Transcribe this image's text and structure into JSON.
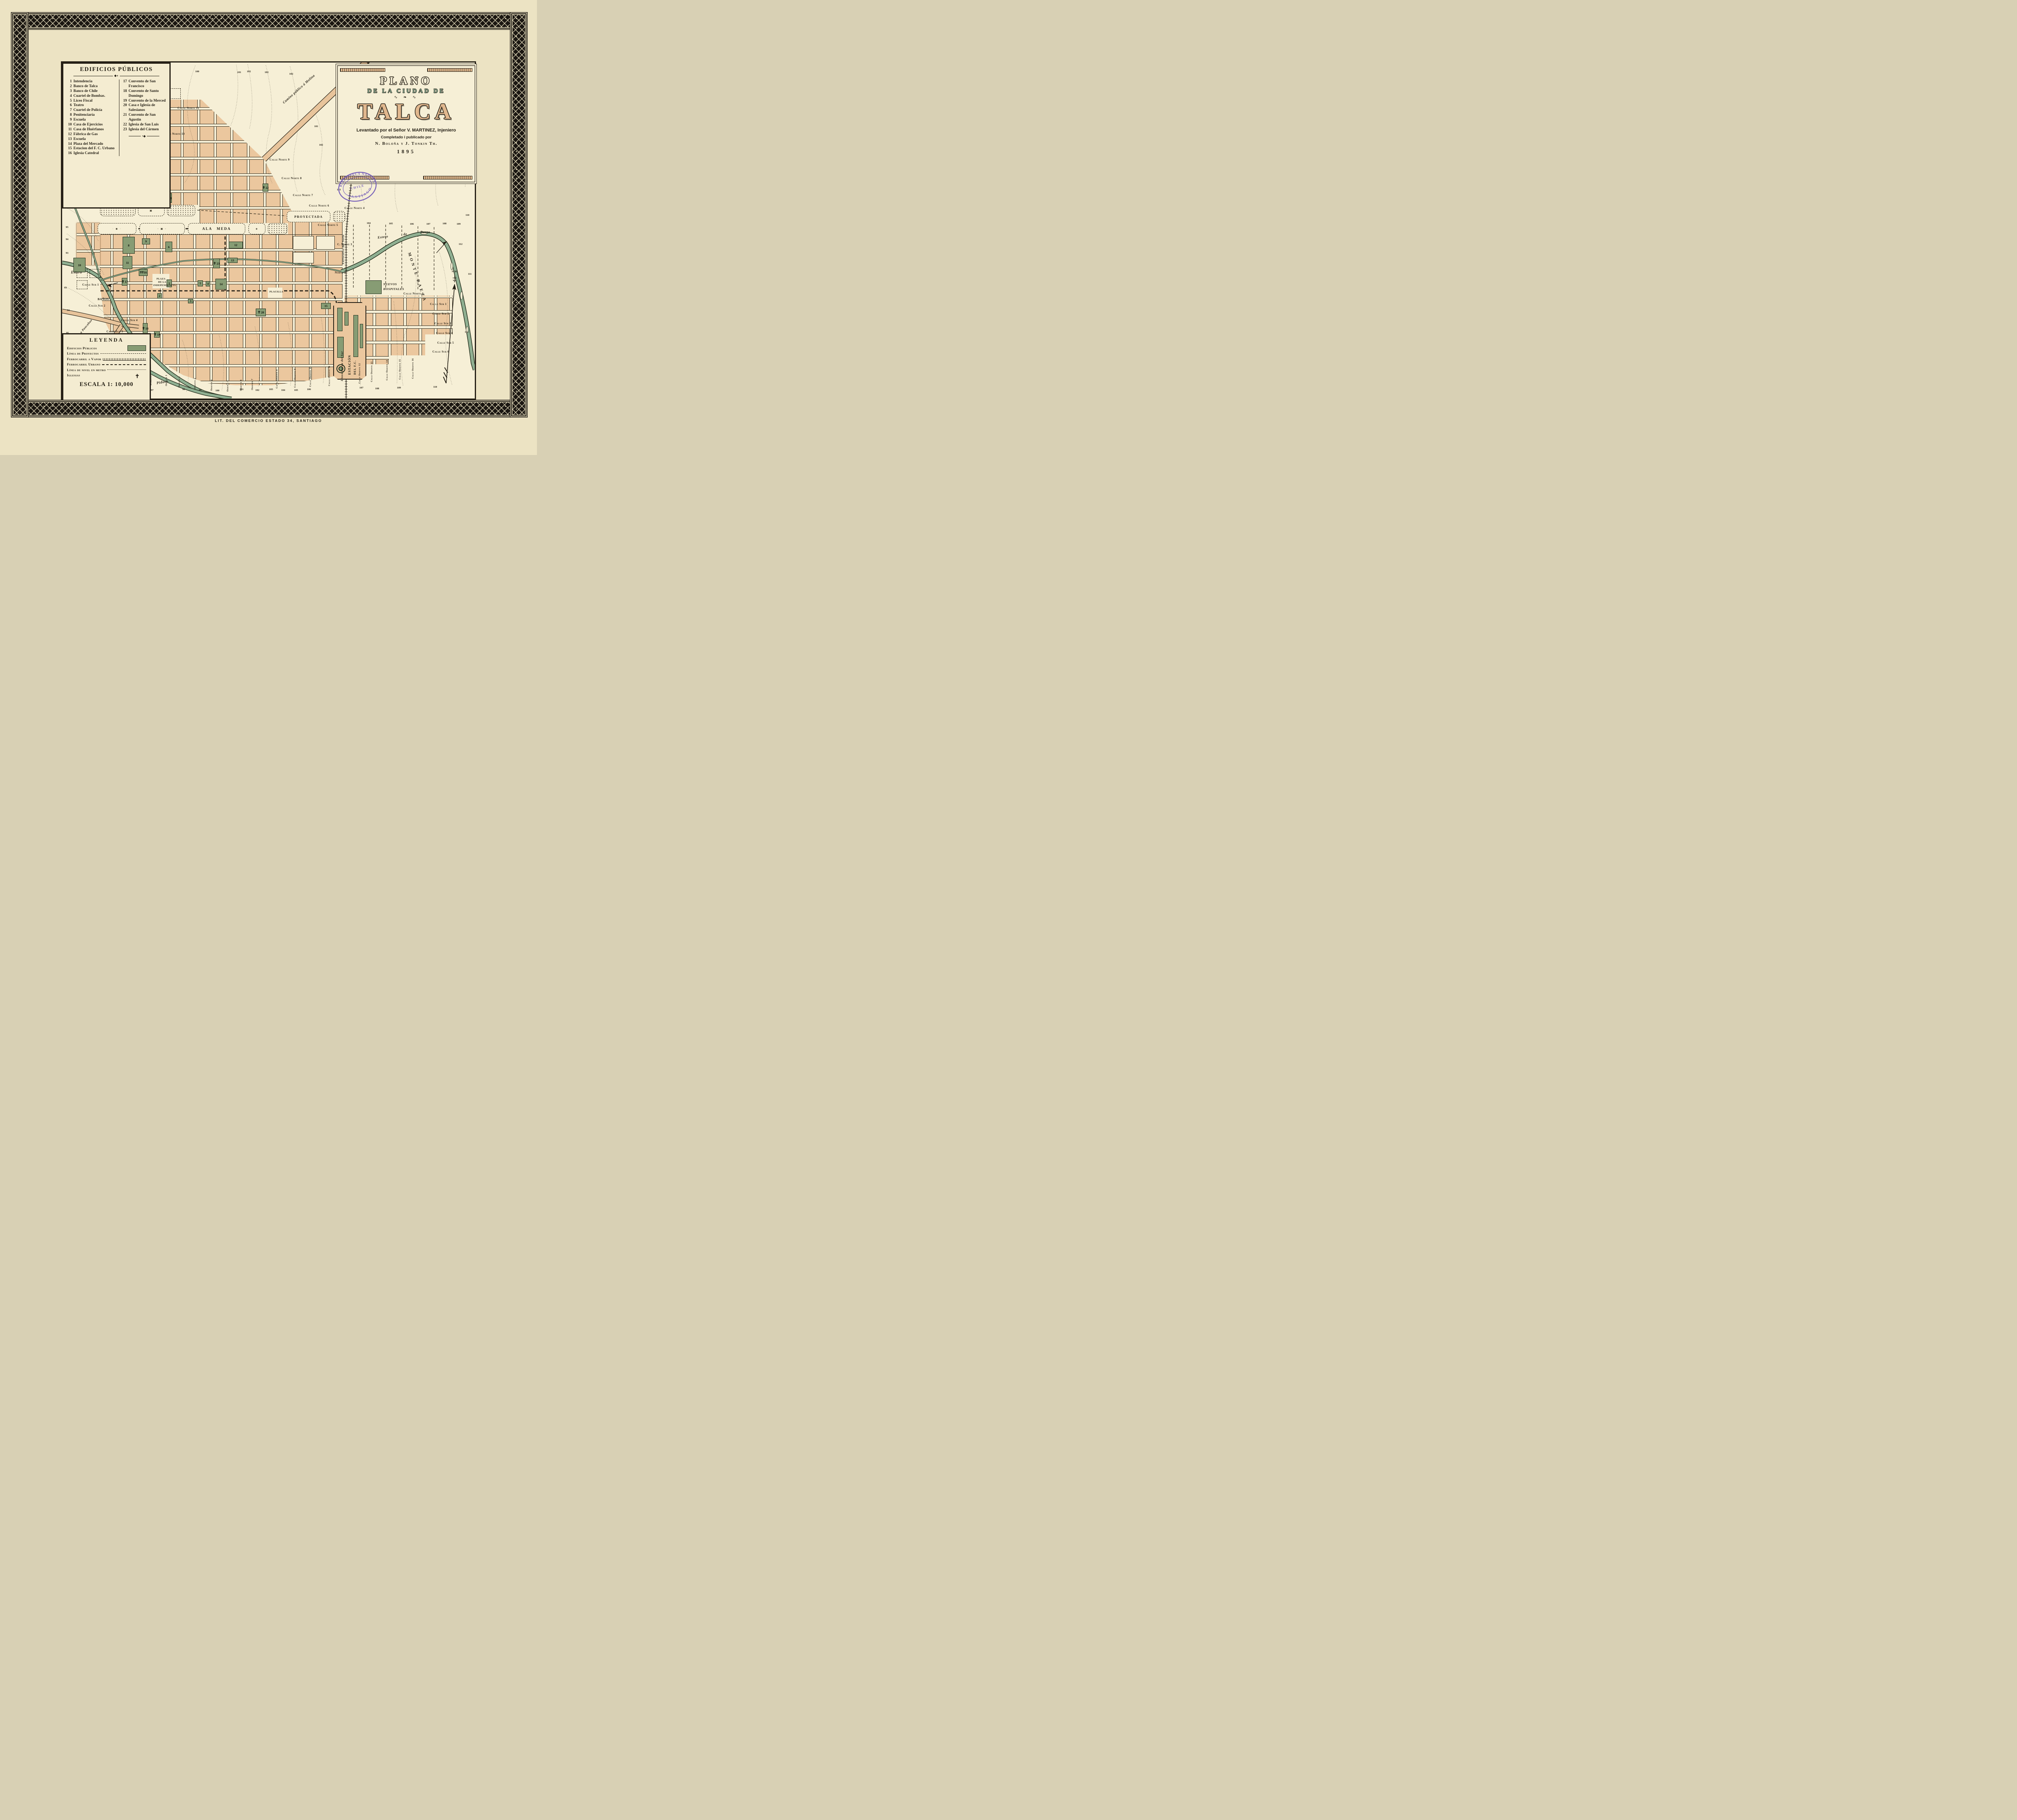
{
  "page": {
    "caption": "LIT. DEL COMERCIO ESTADO 34, SANTIAGO"
  },
  "colors": {
    "page_background": "#ece3c3",
    "map_paper": "#f6efd6",
    "ink": "#241f15",
    "city_block": "#ebc79e",
    "public_building_green": "#879c74",
    "river_green": "#90b092",
    "title_tan": "#e0b78e",
    "title_green": "#7fa088",
    "stamp_purple": "#6f58b8"
  },
  "edificios": {
    "title": "EDIFICIOS PÚBLICOS",
    "items": [
      {
        "n": "1",
        "label": "Intendencia"
      },
      {
        "n": "2",
        "label": "Banco de Talca"
      },
      {
        "n": "3",
        "label": "Banco de Chile"
      },
      {
        "n": "4",
        "label": "Cuartel de Bombas."
      },
      {
        "n": "5",
        "label": "Liceo Fiscal"
      },
      {
        "n": "6",
        "label": "Teatro"
      },
      {
        "n": "7",
        "label": "Cuartel de Policía"
      },
      {
        "n": "8",
        "label": "Penitenciaría"
      },
      {
        "n": "9",
        "label": "Escuela"
      },
      {
        "n": "10",
        "label": "Casa de Ejercicios"
      },
      {
        "n": "11",
        "label": "Casa de Huérfanos"
      },
      {
        "n": "12",
        "label": "Fábrica de Gas"
      },
      {
        "n": "13",
        "label": "Escuela"
      },
      {
        "n": "14",
        "label": "Plaza del Mercado"
      },
      {
        "n": "15",
        "label": "Estacion del F. C. Urbano"
      },
      {
        "n": "16",
        "label": "Iglesia Catedral"
      },
      {
        "n": "17",
        "label": "Convento de San Francisco"
      },
      {
        "n": "18",
        "label": "Convento de Santo Domingo"
      },
      {
        "n": "19",
        "label": "Convento de la Merced"
      },
      {
        "n": "20",
        "label": "Casa e Iglesia de Salesianos"
      },
      {
        "n": "21",
        "label": "Convento de San Agustin"
      },
      {
        "n": "22",
        "label": "Iglesia de San Luis"
      },
      {
        "n": "23",
        "label": "Iglesia del Cármen"
      }
    ]
  },
  "cartouche": {
    "plano": "PLANO",
    "de_la_ciudad": "DE LA CIUDAD DE",
    "talca": "TALCA",
    "credit1": "Levantado por el Señor V. MARTINEZ, Injeniero",
    "credit2": "Completado i publicado por",
    "credit3": "N. Boloña y J. Tonkin Th.",
    "year": "1895"
  },
  "stamp": {
    "top": "BIBLIOTECA NACIONAL",
    "middle": "CHILE",
    "bottom": "SANTIAGO"
  },
  "leyenda": {
    "title": "LEYENDA",
    "items": [
      {
        "label": "Edificios Públicos"
      },
      {
        "label": "Línea de Proyectos"
      },
      {
        "label": "Ferrocarril a Vapor"
      },
      {
        "label": "Ferrocarril Urbano"
      },
      {
        "label": "Línea de nivel en metro"
      },
      {
        "label": "Iglesias"
      }
    ],
    "scale": "ESCALA 1: 10,000"
  },
  "map": {
    "labels": {
      "norte11": "Calle Norte 11",
      "norte10": "Calle Norte 10",
      "norte9": "Calle Norte 9",
      "norte8": "Calle Norte 8",
      "norte7": "Calle Norte 7",
      "norte6": "Calle Norte 6",
      "norte5": "Calle Norte 5",
      "norte4": "Calle Norte 4",
      "norte4w": "Calle Norte 4",
      "norte3": "C. Norte 3",
      "norte2": "Norte 2",
      "norte1": "Calle Norte 1",
      "alameda": "ALA MEDA",
      "proyectada": "PROYECTADA",
      "molina": "Camino público á Molina",
      "pencahue": "Camino a Pancahue",
      "estero": "Estero",
      "estero_b1": "Estero",
      "estero_b2": "de",
      "estero_b3": "Baeza",
      "piduco": "Piduco",
      "banos": "BAÑOS",
      "placilla": "PLACILLA",
      "plaza1": "PLAZA",
      "plaza2": "DE LA",
      "plaza3": "INDEPENDENCIA",
      "hosp1": "NUEVOS",
      "hosp2": "HOSPITALES",
      "est1": "ESTACIÓN",
      "est2": "DEL F.C.",
      "est3": "DEL ESTADO",
      "fcn": "Ferrocarril del Norte",
      "lfs": "Línea férrea del Sur",
      "monte": "MONTE BAEZA",
      "nm": "N.M.",
      "sur1l": "Calle Sur 1",
      "sur2l": "Calle Sur 2",
      "sur3l": "Calle Sur 3",
      "sur4l": "Calle Sur 4",
      "sur1r": "Calle Sur 1",
      "sur2r": "Calle Sur 2",
      "sur3r": "Calle Sur 3",
      "sur4r": "Calle Sur 4",
      "sur5r": "Calle Sur 5",
      "sur6r": "Calle Sur 6",
      "sur6f": "Calle Sur 6",
      "poniente": "Poniente",
      "o1": "Oriente 1",
      "o2": "Oriente 2",
      "o3": "Oriente 3",
      "o4": "Oriente 4",
      "o5": "Oriente 5",
      "o6": "Oriente 6",
      "o7": "Oriente 7",
      "co8": "Calle Oriente 8",
      "co9": "Calle Oriente 9",
      "co10": "Calle Oriente 10",
      "co11": "Calle Oriente 11",
      "co12": "Calle Oriente 12",
      "co13": "Calle Oriente 13",
      "co14": "Calle Oriente 14",
      "co15": "Calle Oriente 15",
      "co16": "Calle Oriente 16"
    },
    "buildings": {
      "b1": "1",
      "b2": "2",
      "b3": "3",
      "b4": "4",
      "b5": "5",
      "b6": "6",
      "b7": "7",
      "b8": "8",
      "b9": "9",
      "b10": "10",
      "b11": "11",
      "b12": "12",
      "b13": "13",
      "b14": "14",
      "b15": "15",
      "b16": "16",
      "b17": "17",
      "b18": "18",
      "b19": "19",
      "b20": "20",
      "b21": "21",
      "b22": "22",
      "b23": "23"
    },
    "elevations": [
      "100",
      "101",
      "102",
      "102",
      "102",
      "99",
      "98",
      "97",
      "96",
      "95",
      "94",
      "93",
      "93",
      "94",
      "95",
      "101",
      "102",
      "103",
      "104",
      "105",
      "106",
      "107",
      "108",
      "109",
      "110",
      "111",
      "112",
      "112",
      "96",
      "97",
      "98",
      "99",
      "100",
      "101",
      "102",
      "103",
      "104",
      "105",
      "106",
      "107",
      "108",
      "109",
      "110"
    ]
  }
}
